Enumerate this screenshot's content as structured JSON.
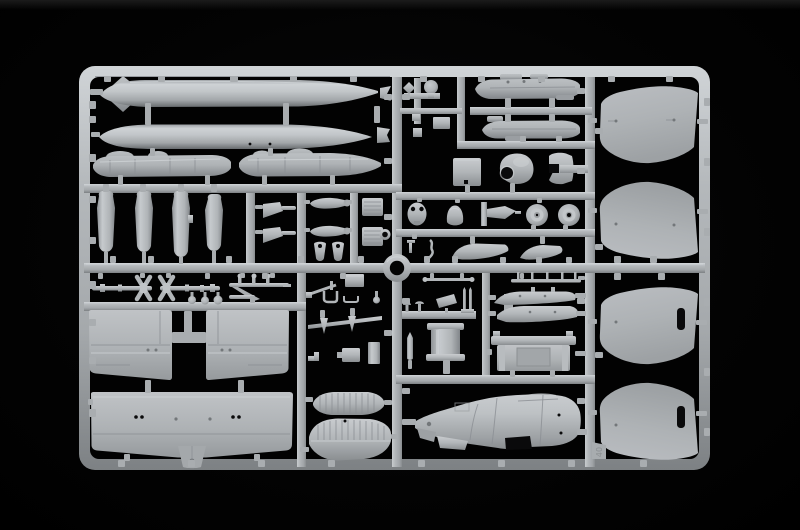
{
  "scene": {
    "title": "Light grey injection-molded model aircraft sprue photographed on a black background",
    "subject": "plastic model kit parts frame (sprue) with aircraft components",
    "background_color": "#000000",
    "plastic_color": "#b4b8bc",
    "molded_marking": "40",
    "parts": [
      "finned drop tank",
      "drop tank",
      "equipment pod left",
      "equipment pod right",
      "bomb half 1",
      "bomb half 2",
      "bomb half 3",
      "bomb half 4",
      "gear door 1",
      "gear door 2",
      "propeller blade 1",
      "propeller blade 2",
      "wheel spat leg 1",
      "wheel spat leg 2",
      "louvre stack 1",
      "louvre stack 2",
      "ring grommet",
      "antenna mast cluster",
      "engine nacelle half upper",
      "engine nacelle half lower",
      "access panel plate",
      "engine cowling",
      "c-bracket",
      "instrument oval",
      "nose dome",
      "cradle bracket",
      "wheel 1",
      "wheel 2",
      "s-hook",
      "wing fillet 1",
      "wing fillet 2",
      "upper wing half left",
      "upper wing half right",
      "one-piece lower wing",
      "propeller shaft 1",
      "propeller shaft 2",
      "knob trio",
      "gun assembly",
      "stores box",
      "pole part",
      "u-brackets",
      "arrow bracket",
      "small box",
      "vertical plate",
      "radiator core small",
      "radiator core large",
      "antenna rod short",
      "antenna rod long",
      "mushroom vents",
      "tilted plate",
      "fork pins",
      "cylinder drum",
      "small bomb",
      "flap section 1",
      "flap section 2",
      "equipment pallet",
      "fuselage half",
      "outer wing panel 1",
      "outer wing panel 2",
      "outer wing panel 3",
      "outer wing panel 4"
    ]
  }
}
